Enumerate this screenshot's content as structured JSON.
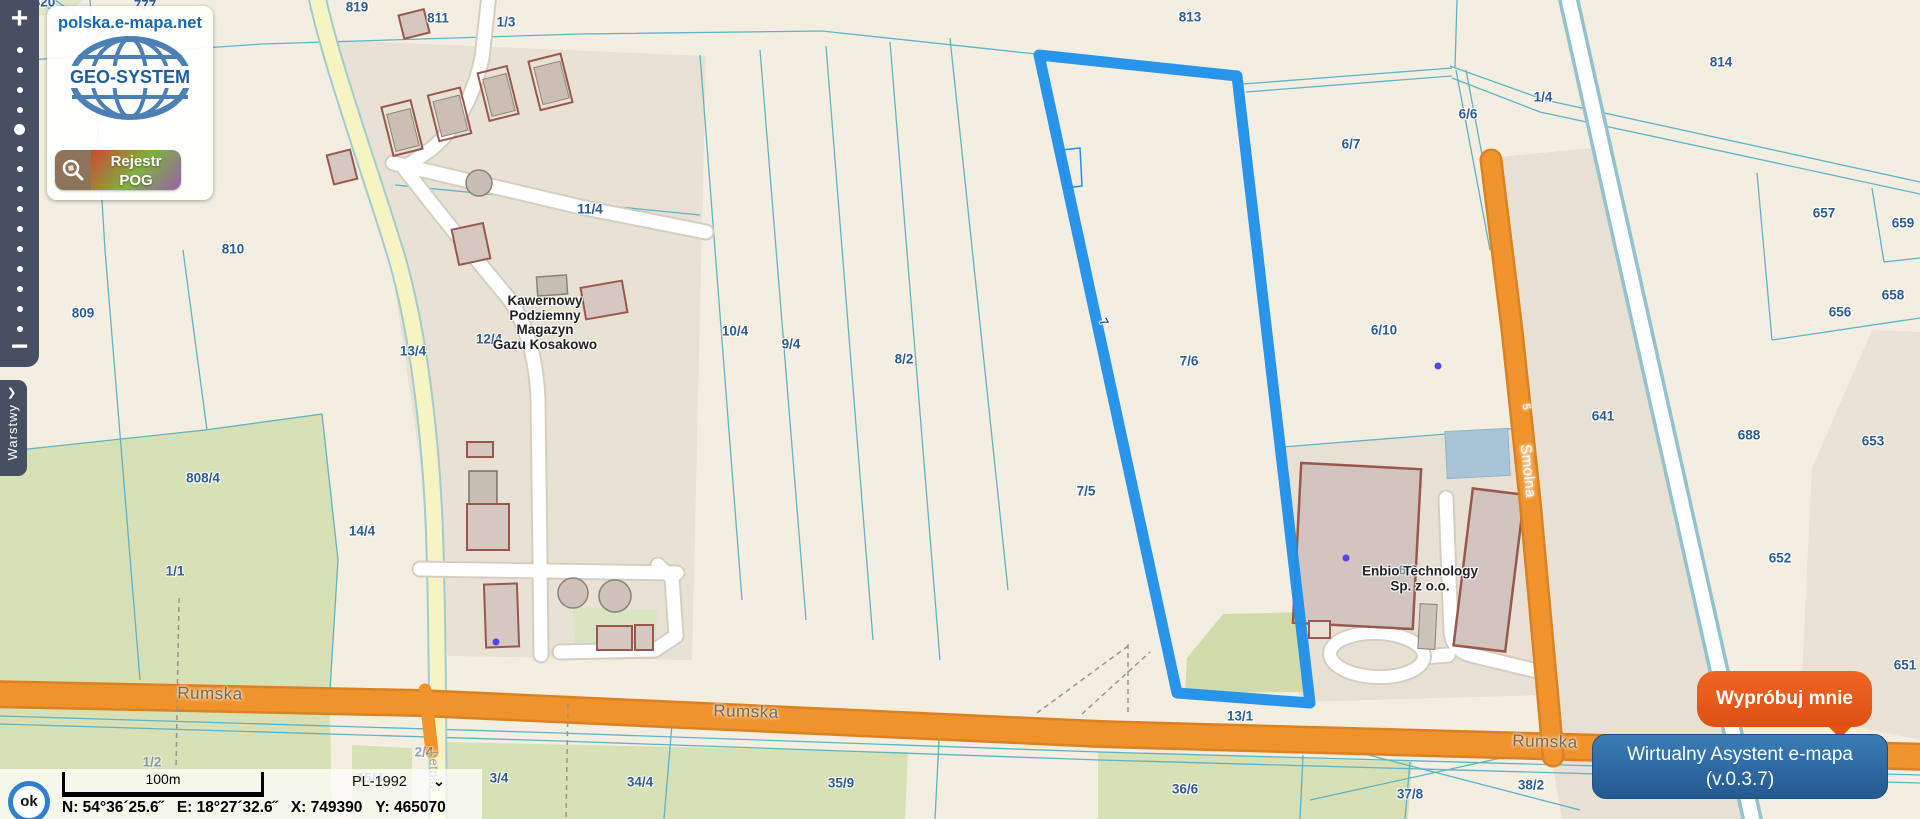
{
  "app": {
    "site_name": "polska.e-mapa.net",
    "logo_brand": "GEO-SYSTEM",
    "badge": {
      "line1": "Rejestr",
      "line2": "POG"
    }
  },
  "toolbar": {
    "zoom_in_label": "+",
    "zoom_out_label": "−",
    "tick_count": 15,
    "active_tick_index": 4,
    "layers_tab_label": "Warstwy",
    "layers_tab_arrow": "❯"
  },
  "status_bar": {
    "ok_label": "ok",
    "scale_label": "100m",
    "crs_label": "PL-1992",
    "crs_arrow": "⌄",
    "coord_n": "N: 54°36´25.6˝",
    "coord_e": "E: 18°27´32.6˝",
    "coord_x": "X: 749390",
    "coord_y": "Y: 465070"
  },
  "assistant": {
    "cta_label": "Wypróbuj mnie",
    "panel_line1": "Wirtualny Asystent e-mapa",
    "panel_line2": "(v.0.3.7)"
  },
  "poi": {
    "gas_storage_lines": [
      "Kawernowy",
      "Podziemny",
      "Magazyn",
      "Gazu Kosakowo"
    ],
    "enbio_lines": [
      "Enbio Technology",
      "Sp. z o.o."
    ]
  },
  "map_labels": {
    "parcels": [
      {
        "t": "820",
        "x": 44,
        "y": 2
      },
      {
        "t": "777",
        "x": 145,
        "y": 5
      },
      {
        "t": "819",
        "x": 357,
        "y": 7
      },
      {
        "t": "811",
        "x": 438,
        "y": 18
      },
      {
        "t": "1/3",
        "x": 506,
        "y": 22
      },
      {
        "t": "813",
        "x": 1190,
        "y": 17
      },
      {
        "t": "814",
        "x": 1721,
        "y": 62
      },
      {
        "t": "1/4",
        "x": 1543,
        "y": 97
      },
      {
        "t": "6/6",
        "x": 1468,
        "y": 114
      },
      {
        "t": "6/7",
        "x": 1351,
        "y": 144
      },
      {
        "t": "11/4",
        "x": 590,
        "y": 209
      },
      {
        "t": "657",
        "x": 1824,
        "y": 213
      },
      {
        "t": "659",
        "x": 1903,
        "y": 223
      },
      {
        "t": "810",
        "x": 233,
        "y": 249
      },
      {
        "t": "658",
        "x": 1893,
        "y": 295
      },
      {
        "t": "656",
        "x": 1840,
        "y": 312
      },
      {
        "t": "809",
        "x": 83,
        "y": 313
      },
      {
        "t": "7",
        "x": 1104,
        "y": 322,
        "rot": 62,
        "size": 12
      },
      {
        "t": "6/10",
        "x": 1384,
        "y": 330
      },
      {
        "t": "10/4",
        "x": 735,
        "y": 331
      },
      {
        "t": "12/4",
        "x": 489,
        "y": 339
      },
      {
        "t": "9/4",
        "x": 791,
        "y": 344
      },
      {
        "t": "13/4",
        "x": 413,
        "y": 351
      },
      {
        "t": "8/2",
        "x": 904,
        "y": 359
      },
      {
        "t": "7/6",
        "x": 1189,
        "y": 361
      },
      {
        "t": "641",
        "x": 1603,
        "y": 416
      },
      {
        "t": "807",
        "x": -4,
        "y": 420
      },
      {
        "t": "688",
        "x": 1749,
        "y": 435
      },
      {
        "t": "653",
        "x": 1873,
        "y": 441
      },
      {
        "t": "808/4",
        "x": 203,
        "y": 478
      },
      {
        "t": "7/5",
        "x": 1086,
        "y": 491
      },
      {
        "t": "14/4",
        "x": 362,
        "y": 531
      },
      {
        "t": "652",
        "x": 1780,
        "y": 558
      },
      {
        "t": "6/9",
        "x": 1408,
        "y": 570,
        "fade": true
      },
      {
        "t": "1/1",
        "x": 175,
        "y": 571
      },
      {
        "t": "651",
        "x": 1905,
        "y": 665
      },
      {
        "t": "13/1",
        "x": 1240,
        "y": 716
      },
      {
        "t": "1/2",
        "x": 152,
        "y": 762,
        "fade": true
      },
      {
        "t": "2/4",
        "x": 424,
        "y": 752,
        "fade": true
      },
      {
        "t": "15/4",
        "x": 370,
        "y": 778,
        "fade": true
      },
      {
        "t": "3/4",
        "x": 499,
        "y": 778
      },
      {
        "t": "34/4",
        "x": 640,
        "y": 782
      },
      {
        "t": "35/9",
        "x": 841,
        "y": 783
      },
      {
        "t": "36/6",
        "x": 1185,
        "y": 789
      },
      {
        "t": "37/8",
        "x": 1410,
        "y": 794
      },
      {
        "t": "38/2",
        "x": 1531,
        "y": 785
      }
    ],
    "streets": [
      {
        "t": "Rumska",
        "x": 210,
        "y": 694,
        "rot": 1
      },
      {
        "t": "Rumska",
        "x": 746,
        "y": 712,
        "rot": 1.5
      },
      {
        "t": "Rumska",
        "x": 1545,
        "y": 742,
        "rot": 1.5
      },
      {
        "t": "Smolna",
        "x": 1528,
        "y": 471,
        "rot": 84,
        "color": "#ffffff",
        "size": 15
      },
      {
        "t": "5",
        "x": 1526,
        "y": 407,
        "rot": 84,
        "color": "#ffffff",
        "size": 11
      },
      {
        "t": "Letnia",
        "x": 434,
        "y": 770,
        "rot": 90,
        "color": "#98a37f",
        "size": 13
      }
    ]
  },
  "colors": {
    "selection_outline": "#1e8fea",
    "road_primary_orange": "#f0932d",
    "road_yellow": "#f8f3c3",
    "parcel_line_teal": "#5cb4c5",
    "parcel_label_blue": "#2a5c92",
    "vegetation_green": "#d8e0b5",
    "building_fill": "#d6c8c0",
    "building_stroke": "#9a574e",
    "ui_dark": "#475063",
    "cta_orange": "#e05314",
    "assistant_blue": "#2b6da8"
  }
}
